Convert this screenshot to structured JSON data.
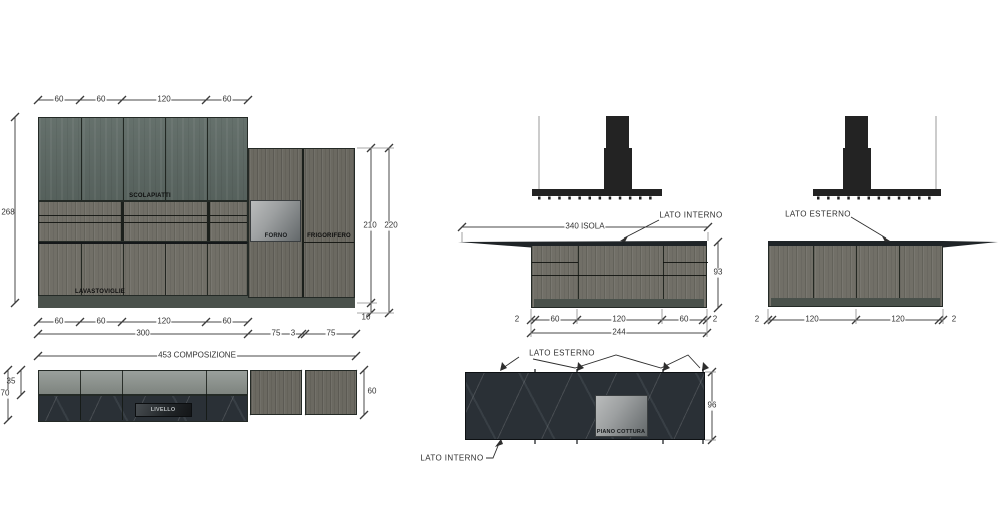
{
  "drawing_title": "kitchen composition technical elevations",
  "elevation_main": {
    "dims_top": [
      "60",
      "60",
      "120",
      "60"
    ],
    "dim_left": "268",
    "dim_right_inner": "210",
    "dim_right_outer": "220",
    "dim_plinth": "10",
    "dims_bottom_row1": [
      "60",
      "60",
      "120",
      "60"
    ],
    "dims_bottom_row2": [
      "300",
      "75",
      "3",
      "75"
    ],
    "dim_total": "453 COMPOSIZIONE",
    "labels": {
      "scolapiatti": "SCOLAPIATTI",
      "forno": "FORNO",
      "frigorifero": "FRIGORIFERO",
      "lavastoviglie": "LAVASTOVIGLIE"
    }
  },
  "plan_main": {
    "dim_strip": "35",
    "dim_depth": "70",
    "dim_tall_depth": "60",
    "labels": {
      "livello": "LIVELLO"
    }
  },
  "island_interno": {
    "label_side": "LATO INTERNO",
    "dim_width": "340 ISOLA",
    "dim_height": "93",
    "dims_bottom_row1": [
      "2",
      "60",
      "120",
      "60",
      "2"
    ],
    "dim_total": "244"
  },
  "island_esterno": {
    "label_side": "LATO ESTERNO",
    "dims_bottom": [
      "2",
      "120",
      "120",
      "2"
    ]
  },
  "plan_island": {
    "label_top": "LATO ESTERNO",
    "label_bottom": "LATO INTERNO",
    "label_hob": "PIANO COTTURA",
    "dim_depth": "96"
  },
  "colors": {
    "teal": "#5d6964",
    "wood": "#716f67",
    "wood_dark": "#6b6961",
    "marble": "#2a3036",
    "plinth": "#4a514b",
    "hood": "#232323",
    "counter_black": "#1f2427",
    "dimline": "#4a4a4a",
    "extline": "#8a8a8a"
  }
}
